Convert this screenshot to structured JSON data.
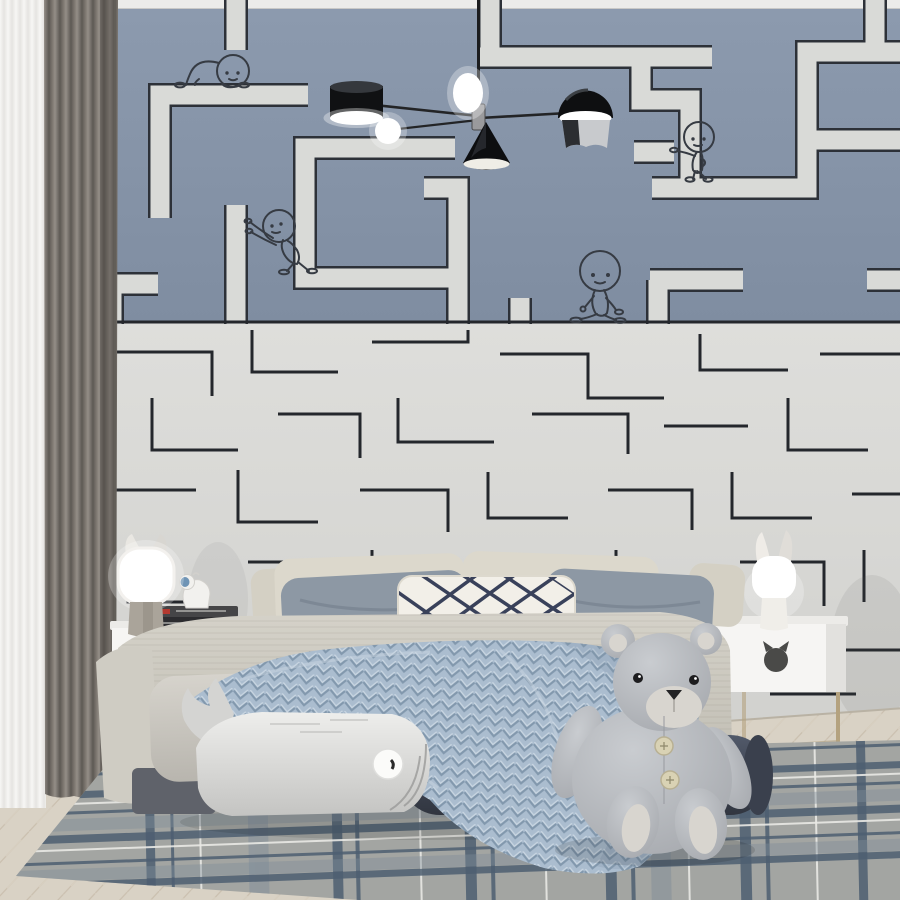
{
  "scene": {
    "kind": "bedroom-interior-photo",
    "theme": "kids bedroom with maze wallpaper",
    "character_count": 4,
    "characters": [
      {
        "pose": "crawling",
        "area": "upper-left"
      },
      {
        "pose": "pushing-wall",
        "area": "mid-left"
      },
      {
        "pose": "leaning-standing",
        "area": "upper-right"
      },
      {
        "pose": "walking",
        "area": "center"
      }
    ]
  },
  "palette": {
    "ceiling": "#ececea",
    "wall_top_blue": "#8694a8",
    "maze_path_light": "#d9dad7",
    "maze_outline_dark": "#2d3138",
    "wall_bottom_light": "#dcdcd9",
    "maze_thin_line": "#24272c",
    "curtain_sheer": "#f3f2ef",
    "curtain_main": "#7a746d",
    "floor_wood": "#d9d2c5",
    "rug_base": "#a3a5a2",
    "rug_navy": "#4e5f71",
    "bedspread": "#ccc9c0",
    "pillow_cream": "#dcd8cc",
    "pillow_gray_blue": "#8d98a4",
    "lattice_pillow_bg": "#f2efe8",
    "lattice_line_navy": "#39415a",
    "knit_throw_blue": "#abbdcf",
    "bolster_dark": "#424856",
    "whale_pillow": "#e6e6e4",
    "teddy_bear_gray": "#b9bcc0",
    "bear_pad_cream": "#d8d5cf",
    "nightstand_white": "#f6f5f3",
    "legs_gold": "#b4a27f",
    "lamp_glow_white": "#ffffff",
    "fixture_black": "#141517"
  },
  "objects": {
    "ceiling_lamp": "black multi-arm chandelier with drum, cone, dome shades and glowing globes",
    "curtains": "white sheer plus taupe velvet curtain, left side",
    "wallpaper_top": "blue-gray field with wide light maze paths",
    "wallpaper_bottom": "light field with thin dark maze lines",
    "bed": "double bed with cream and blue-gray pillows, lattice lumbar pillow, chunky knit throw",
    "whale_pillow": "whale-shaped plush pillow at foot of bed",
    "bolster": "dark slate cylindrical bolster",
    "teddy_bear": "large gray plush bear with button belly",
    "nightstand_left": "white nightstand with cat cutout, books and dog figurine, cat-ear lamp",
    "nightstand_right": "white nightstand with cat cutout on gold frame legs, bunny-ear lamp",
    "rug": "gray plaid rug with navy stripes",
    "floor": "light herringbone wood"
  }
}
